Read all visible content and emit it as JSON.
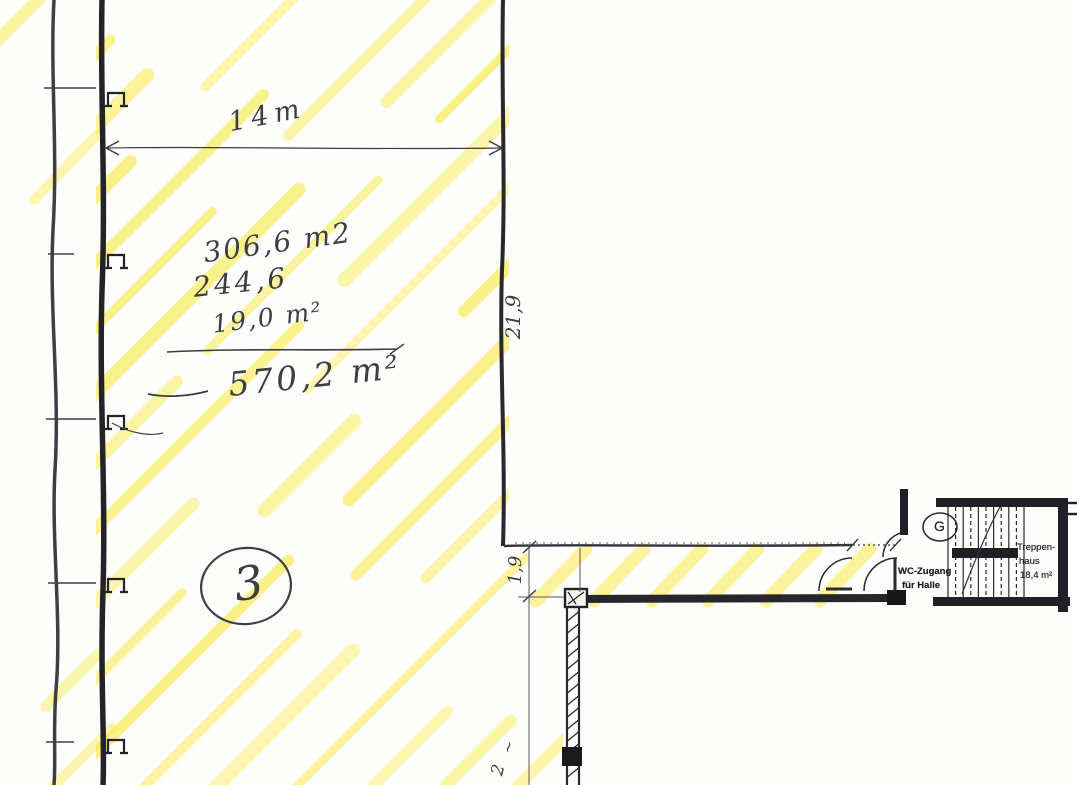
{
  "plan": {
    "hall": {
      "width_label": "14m",
      "length_label": "21,9",
      "room_number": "3",
      "area_lines": [
        "306,6 m2",
        "244,6",
        "19,0 m²"
      ],
      "area_total": "570,2 m²"
    },
    "corridor": {
      "width_label": "1,9",
      "lower_label": "2",
      "lower_mark": "~"
    },
    "stairwell": {
      "badge": "G",
      "label_line1": "Treppen-",
      "label_line2": "haus",
      "label_area": "18,4 m²"
    },
    "wc_access": {
      "line1": "WC-Zugang",
      "line2": "für Halle"
    }
  },
  "colors": {
    "highlighter": "#f7e93d",
    "ink": "#2b2b31"
  }
}
